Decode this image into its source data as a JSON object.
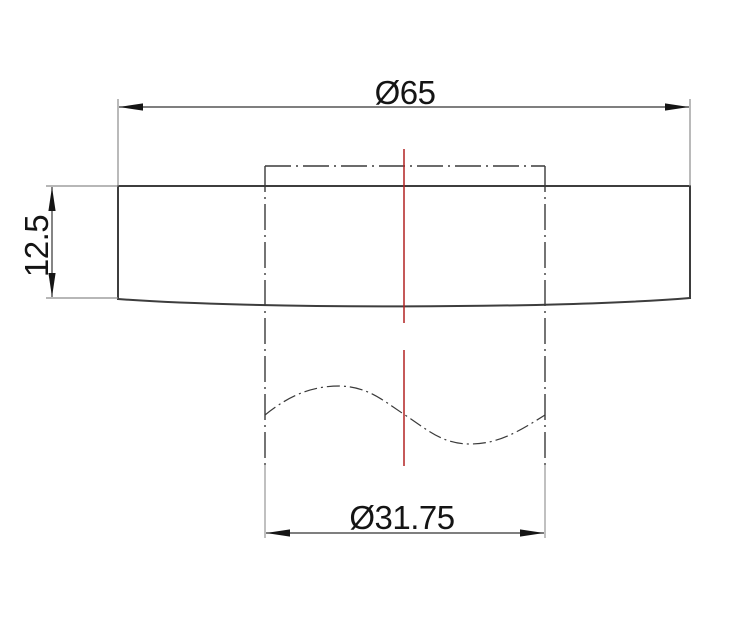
{
  "drawing": {
    "dimensions": {
      "outer_diameter": "Ø65",
      "thickness": "12.5",
      "hub_diameter": "Ø31.75"
    },
    "colors": {
      "background": "#ffffff",
      "outline": "#3d3d3d",
      "hidden": "#3a3a3a",
      "extension": "#8c8c8c",
      "dimension": "#333333",
      "arrow": "#151515",
      "text": "#141414",
      "centerline": "#b22222"
    }
  }
}
